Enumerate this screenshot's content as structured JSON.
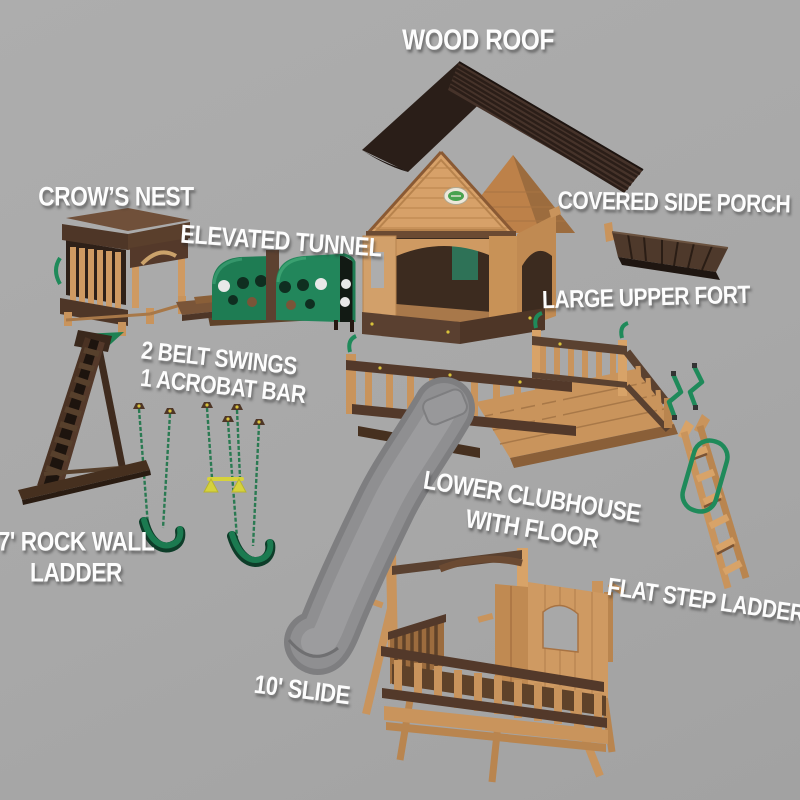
{
  "diagram": {
    "kind": "exploded parts diagram",
    "subject": "wooden backyard playset components"
  },
  "labels": {
    "wood_roof": "WOOD ROOF",
    "crows_nest": "CROW’S NEST",
    "elevated_tunnel": "ELEVATED TUNNEL",
    "covered_side_porch": "COVERED SIDE PORCH",
    "large_upper_fort": "LARGE UPPER FORT",
    "belt_swings_1": "2 BELT SWINGS",
    "belt_swings_2": "1 ACROBAT BAR",
    "rock_wall_1": "7' ROCK WALL",
    "rock_wall_2": "LADDER",
    "lower_clubhouse_1": "LOWER CLUBHOUSE",
    "lower_clubhouse_2": "WITH FLOOR",
    "flat_step_ladder": "FLAT STEP LADDER",
    "slide": "10' SLIDE"
  },
  "colors": {
    "background": "#a8a8a8",
    "label_text": "#ffffff",
    "wood_light": "#d2a06a",
    "wood_mid": "#c9945c",
    "wood_dark": "#8a5f38",
    "trim_brown": "#53392a",
    "roof_brown": "#3a2a21",
    "accent_green": "#1e7c53",
    "accent_yellow": "#d6d23c",
    "slide_gray": "#8f8f91"
  }
}
